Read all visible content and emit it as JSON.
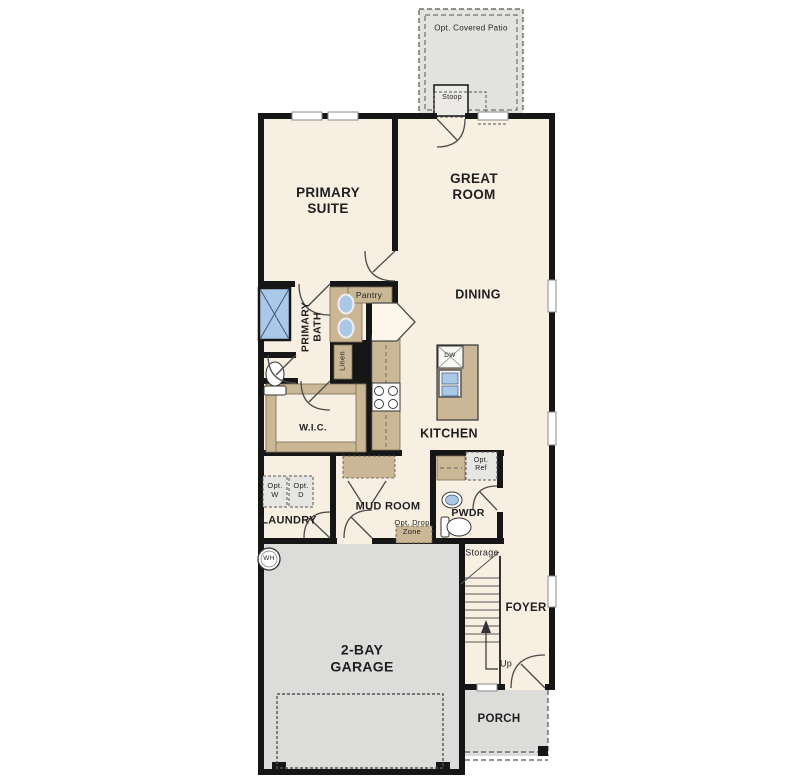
{
  "rooms": {
    "primary_suite": "PRIMARY\nSUITE",
    "great_room": "GREAT\nROOM",
    "dining": "DINING",
    "kitchen": "KITCHEN",
    "primary_bath": "PRIMARY\nBATH",
    "wic": "W.I.C.",
    "laundry": "LAUNDRY",
    "mud_room": "MUD ROOM",
    "pwdr": "PWDR",
    "foyer": "FOYER",
    "storage": "Storage",
    "garage": "2-BAY\nGARAGE",
    "porch": "PORCH",
    "stoop": "Stoop",
    "patio": "Opt. Covered Patio"
  },
  "annotations": {
    "pantry": "Pantry",
    "linen": "Linen",
    "opt_w": "Opt.\nW",
    "opt_d": "Opt.\nD",
    "opt_ref": "Opt.\nRef",
    "opt_drop_zone": "Opt. Drop\nZone",
    "dw": "DW",
    "wh": "WH",
    "up": "Up"
  },
  "colors": {
    "floor": "#f7efe1",
    "garage_floor": "#dcdcda",
    "patio_floor": "#e2e2df",
    "wall": "#161616",
    "cabinet": "#cab795",
    "fixture_blue": "#aac9e9",
    "label": "#1f1f1f"
  }
}
